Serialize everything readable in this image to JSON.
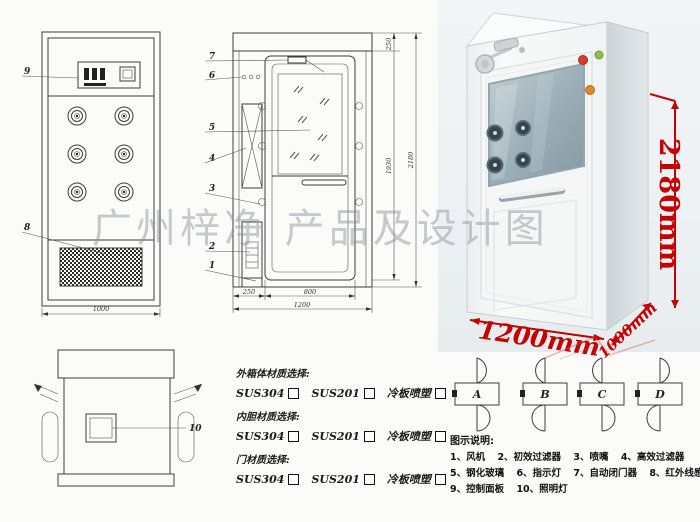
{
  "watermark": {
    "text": "广州梓净 产品及设计图"
  },
  "front_view": {
    "callout_9": "9",
    "callout_8": "8",
    "dim_width": "1000"
  },
  "side_view": {
    "callouts": [
      "7",
      "6",
      "5",
      "4",
      "3",
      "2",
      "1"
    ],
    "dim_top": "250",
    "dim_inner_height": "1930",
    "dim_total_height": "2180",
    "dim_fan_depth": "250",
    "dim_door_width": "800",
    "dim_total_depth": "1200"
  },
  "top_view": {
    "callout_10": "10"
  },
  "photo": {
    "dim_height": "2180mm",
    "dim_width": "1200mm",
    "dim_depth": "1000mm",
    "colors": {
      "dimension": "#c40000",
      "cabinet": "#f7f8f7",
      "window": "#9db0b9"
    }
  },
  "materials": {
    "groups": [
      {
        "title": "外箱体材质选择:",
        "options": [
          "SUS304",
          "SUS201",
          "冷板喷塑"
        ]
      },
      {
        "title": "内胆材质选择:",
        "options": [
          "SUS304",
          "SUS201",
          "冷板喷塑"
        ]
      },
      {
        "title": "门材质选择:",
        "options": [
          "SUS304",
          "SUS201",
          "冷板喷塑"
        ]
      }
    ]
  },
  "door_swing": {
    "options": [
      "A",
      "B",
      "C",
      "D"
    ]
  },
  "legend": {
    "title": "图示说明:",
    "rows": [
      [
        "1、风机",
        "2、初效过滤器",
        "3、喷嘴",
        "4、高效过滤器"
      ],
      [
        "5、钢化玻璃",
        "6、指示灯",
        "7、自动闭门器",
        "8、红外线感应器"
      ],
      [
        "9、控制面板",
        "10、照明灯"
      ]
    ]
  }
}
